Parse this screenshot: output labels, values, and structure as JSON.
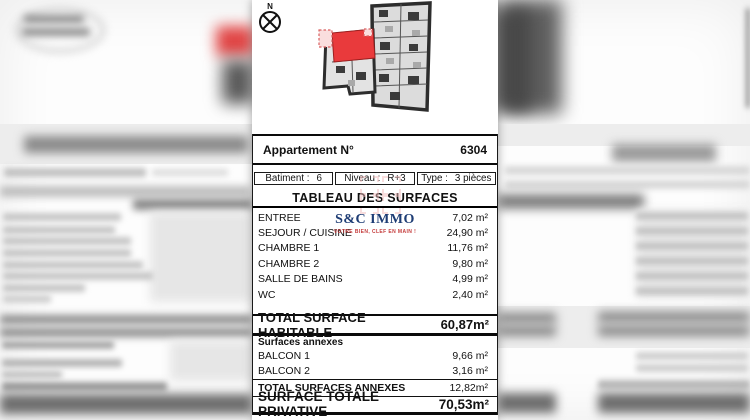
{
  "plan": {
    "compass_label": "N",
    "highlight_color": "#e93a3c",
    "wall_color": "#2d2d2d"
  },
  "watermark": {
    "name": "S&C IMMO",
    "tagline": "VOTRE BIEN, CLEF EN MAIN !",
    "name_color": "#1d3c74",
    "tagline_color": "#c43b3b"
  },
  "doc": {
    "apartment": {
      "label": "Appartement N°",
      "number": "6304"
    },
    "info_cells": [
      {
        "label": "Batiment :",
        "value": "6"
      },
      {
        "label": "Niveau :",
        "value": "R+3"
      },
      {
        "label": "Type :",
        "value": "3 pièces"
      }
    ],
    "table_title": "TABLEAU DES SURFACES",
    "surfaces": [
      {
        "name": "ENTREE",
        "area": "7,02 m²"
      },
      {
        "name": "SEJOUR / CUISINE",
        "area": "24,90 m²"
      },
      {
        "name": "CHAMBRE 1",
        "area": "11,76 m²"
      },
      {
        "name": "CHAMBRE 2",
        "area": "9,80 m²"
      },
      {
        "name": "SALLE DE BAINS",
        "area": "4,99 m²"
      },
      {
        "name": "WC",
        "area": "2,40 m²"
      }
    ],
    "total_habitable": {
      "label": "TOTAL SURFACE HABITABLE",
      "area": "60,87m²"
    },
    "annexes_heading": "Surfaces annexes",
    "annexes": [
      {
        "name": "BALCON 1",
        "area": "9,66 m²"
      },
      {
        "name": "BALCON 2",
        "area": "3,16 m²"
      }
    ],
    "total_annexes": {
      "label": "TOTAL SURFACES ANNEXES",
      "area": "12,82m²"
    },
    "total_privative": {
      "label": "SURFACE TOTALE PRIVATIVE",
      "area": "70,53m²"
    }
  }
}
